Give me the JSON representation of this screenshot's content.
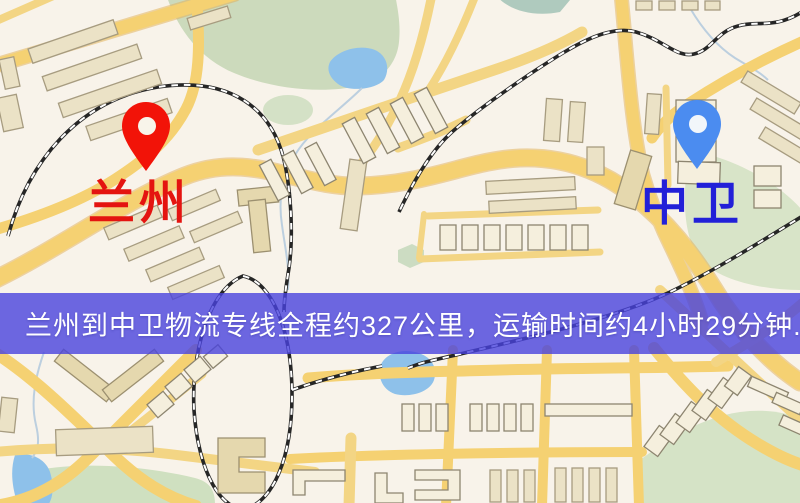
{
  "origin": {
    "name": "兰州",
    "pin_color": "#f21308",
    "label_color": "#e41410"
  },
  "destination": {
    "name": "中卫",
    "pin_color": "#4b8cf0",
    "label_color": "#2220d8"
  },
  "banner": {
    "text": "兰州到中卫物流专线全程约327公里，运输时间约4小时29分钟.",
    "background": "rgba(73,66,221,0.8)",
    "text_color": "#ffffff"
  },
  "route": {
    "distance": "327公里",
    "duration": "4小时29分钟"
  },
  "map_colors": {
    "background": "#f8f3ea",
    "road": "#f5d172",
    "road_casing": "#e2b055",
    "park": "#cddcbe",
    "water": "#8ec1ea",
    "building": "#ebe2c6",
    "railway": "#262626"
  }
}
